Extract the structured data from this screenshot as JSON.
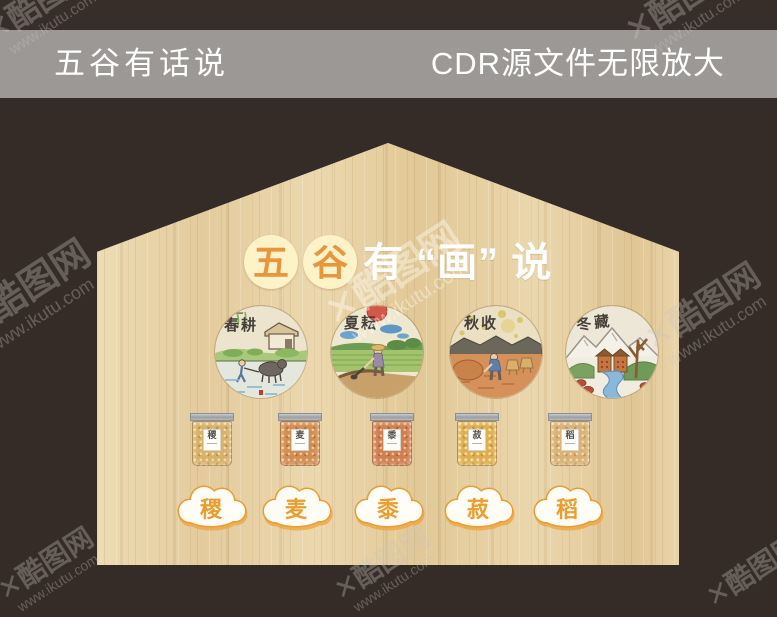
{
  "header": {
    "left_title": "五谷有话说",
    "right_title": "CDR源文件无限放大"
  },
  "title": {
    "circled": [
      "五",
      "谷"
    ],
    "suffix": "有 “画” 说"
  },
  "seasons": [
    {
      "label": "春耕"
    },
    {
      "label": "夏耘"
    },
    {
      "label": "秋收"
    },
    {
      "label": "冬藏"
    }
  ],
  "grains": [
    {
      "char": "稷"
    },
    {
      "char": "麦"
    },
    {
      "char": "黍"
    },
    {
      "char": "菽"
    },
    {
      "char": "稻"
    }
  ],
  "watermark": {
    "mark": "✕",
    "site_name": "酷图网",
    "site_url": "www.ikutu.com"
  },
  "colors": {
    "background": "#352C28",
    "header_bar": "#9C9896",
    "wood": "#E9D5AB",
    "accent_orange": "#F0A134",
    "title_circle_yellow": "#FDF2C8",
    "title_char_orange": "#E8953C"
  }
}
